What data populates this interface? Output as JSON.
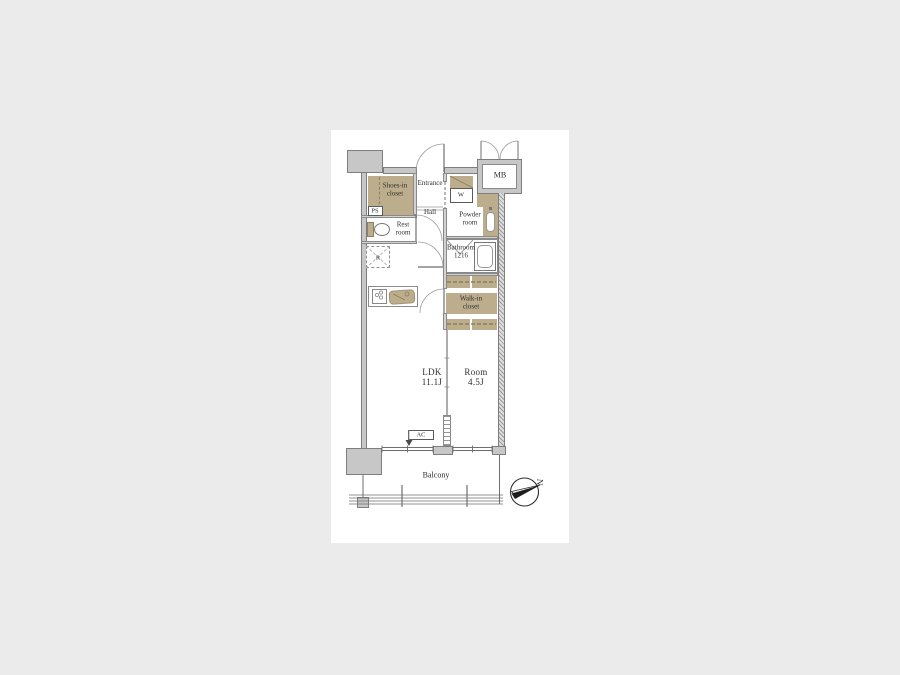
{
  "page": {
    "background_color": "#ebebeb",
    "panel_color": "#ffffff"
  },
  "floorplan": {
    "rooms": {
      "shoes_closet": "Shoes-in\ncloset",
      "entrance": "Entrance",
      "meter_box": "MB",
      "washer": "W",
      "pipe_space": "PS",
      "hall": "Hall",
      "rest_room": "Rest\nroom",
      "powder_room": "Powder\nroom",
      "bathroom": "Bathroom\n1216",
      "refrigerator": "R",
      "walk_in_closet": "Walk-in\ncloset",
      "ldk": "LDK\n11.1J",
      "room": "Room\n4.5J",
      "air_conditioner": "AC",
      "balcony": "Balcony"
    },
    "compass": {
      "letter": "N"
    },
    "colors": {
      "wall_fill": "#c7c7c7",
      "wall_border": "#7e7e7e",
      "closet_fill": "#bcad8d",
      "closet_dash": "#8d7f60",
      "line": "#6f6f6f",
      "text": "#2e2e2e"
    }
  }
}
